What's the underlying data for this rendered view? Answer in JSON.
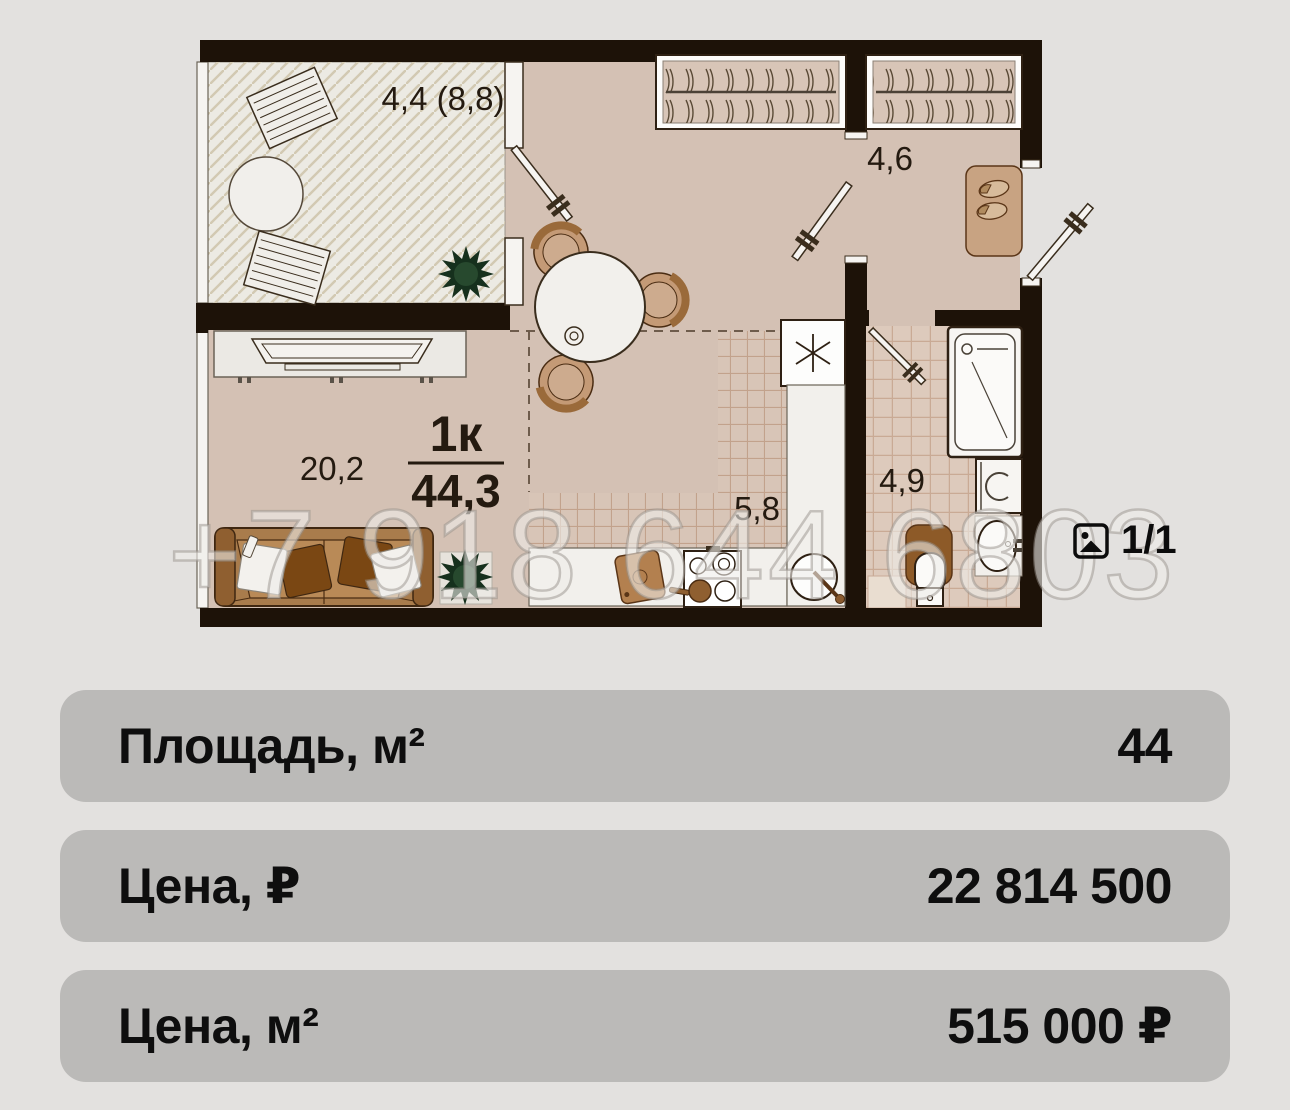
{
  "floorplan": {
    "type_label": "1к",
    "total_area": "44,3",
    "rooms": {
      "balcony": "4,4 (8,8)",
      "hallway": "4,6",
      "living": "20,2",
      "kitchen": "5,8",
      "bathroom": "4,9"
    },
    "watermark": "+7 918 644 6803",
    "photo_counter": "1/1"
  },
  "details": {
    "rows": [
      {
        "label": "Площадь, м²",
        "value": "44"
      },
      {
        "label": "Цена, ₽",
        "value": "22 814 500"
      },
      {
        "label": "Цена, м²",
        "value": "515 000 ₽"
      }
    ]
  },
  "colors": {
    "page_bg": "#e3e1df",
    "wall": "#1d1208",
    "floor": "#d4c1b4",
    "balcony_floor": "#eceae3",
    "kitchen_tile": "#d8c5b7",
    "bath_tile": "#ddcabc",
    "row_bg": "#bbbab8",
    "fixture_white": "#f6f4f1",
    "wood_brown": "#a97c4c"
  }
}
